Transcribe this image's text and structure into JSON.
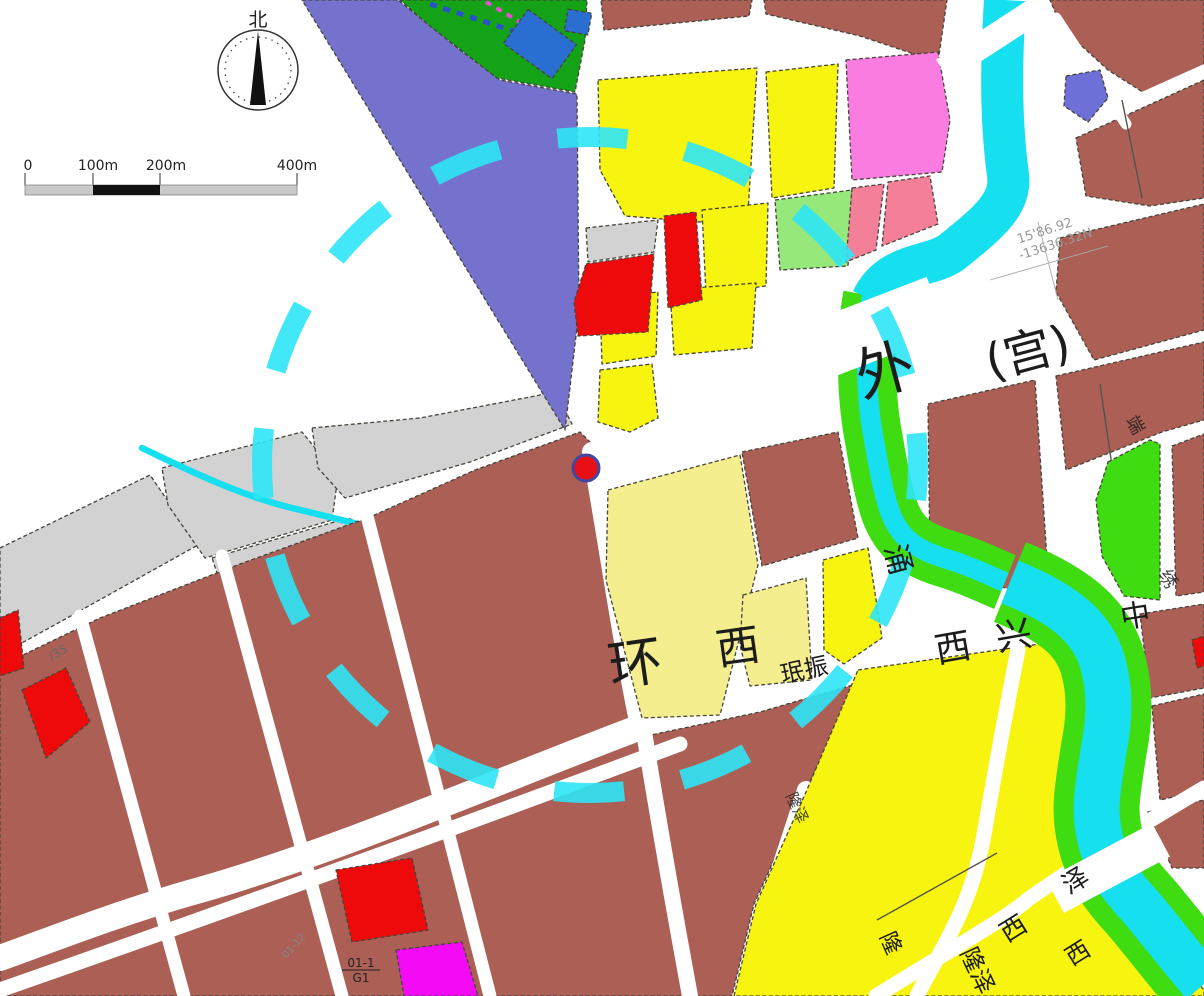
{
  "map": {
    "north_label": "北",
    "scale": {
      "labels": [
        "0",
        "100m",
        "200m",
        "400m"
      ]
    },
    "palette": {
      "parcel_maroon": "#ab5f55",
      "parcel_yellow": "#f7f410",
      "parcel_pale_yellow": "#f5ee8e",
      "parcel_red": "#ee0a0a",
      "parcel_slate": "#7572cd",
      "parcel_blue": "#2b6ed2",
      "parcel_green_dark": "#14a316",
      "parcel_green_bright": "#3fdc12",
      "parcel_green_light": "#97e87a",
      "parcel_pink": "#fb7ce0",
      "parcel_salmon": "#f47f99",
      "parcel_magenta": "#f50af5",
      "parcel_gray": "#d2d2d2",
      "parcel_purpleblue": "#6f6fd8",
      "water_cyan": "#16dff0",
      "circle_cyan": "#2ee6f6",
      "dot_red": "#e81016",
      "dot_ring": "#4446a0",
      "road_white": "#ffffff",
      "rail_blue": "#2b50cc",
      "rail_magenta": "#e54fd2",
      "text_dark": "#1c1c1c",
      "text_faint": "#999999"
    },
    "labels": {
      "wai": "外",
      "gong": "(宫)",
      "huan": "环",
      "xi_hidden": "西",
      "minzhen": "珉振",
      "yong": "涌",
      "xi1": "西",
      "xing": "兴",
      "zhong": "中",
      "duan": "端",
      "xiu": "绣",
      "ze_ne": "泽",
      "xi_r1": "西",
      "longze": "隆泽",
      "xi_r2": "西",
      "long2": "隆",
      "longze2": "隆泽",
      "plot_code_top": "01-1",
      "plot_code_bottom": "G1",
      "plot_code_side": "01-12",
      "coord_line1": "15'86.92",
      "coord_line2": "-13636.32N",
      "road_note": "/35"
    }
  }
}
